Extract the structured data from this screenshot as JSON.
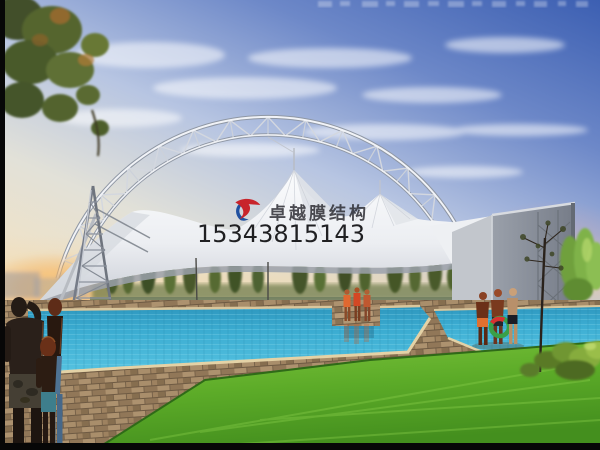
{
  "meta": {
    "description": "Architectural rendering of a white tensile membrane canopy with a steel truss arch over an outdoor swimming pool at dusk",
    "width": 600,
    "height": 450
  },
  "watermark": {
    "company_name": "卓越膜结构",
    "phone_number": "15343815143",
    "company_color": "#26262c",
    "phone_color": "#0e0e10",
    "logo_red": "#c8242b",
    "logo_blue": "#2050a0"
  },
  "scene": {
    "sky": {
      "top_color": "#3f63b4",
      "mid_color": "#aebfde",
      "horizon_color": "#f0ddc0",
      "sunset_glow": "#f2a85a"
    },
    "structure": {
      "arch_color": "#eff1f5",
      "membrane_color": "#f4f5f7",
      "tower_color": "#7e848e",
      "end_wall_color": "#8a909a"
    },
    "ground": {
      "pool_color": "#3fb0d4",
      "deck_color": "#ab9070",
      "lawn_color": "#63b02c"
    },
    "people": {
      "foreground_left_count": 3,
      "poolside_center_count": 3,
      "poolside_right_count": 3
    }
  }
}
